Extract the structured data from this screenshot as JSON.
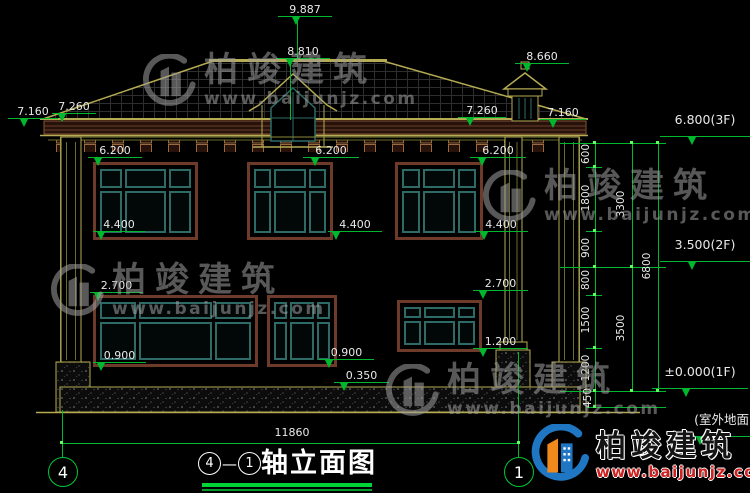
{
  "watermark": {
    "brand": "柏竣建筑",
    "url": "www.baijunjz.com"
  },
  "logo": {
    "brand": "柏竣建筑",
    "url": "www.baijunjz.com"
  },
  "title": {
    "axis_left": "4",
    "separator": "—",
    "axis_right": "1",
    "text": "轴立面图"
  },
  "axes": {
    "left": "4",
    "right": "1"
  },
  "dims": {
    "ridge": "9.887",
    "dormer": "8.810",
    "chimney": "8.660",
    "eave_outer_left": "7.160",
    "eave_inner_left": "7.260",
    "eave_inner_right": "7.260",
    "eave_outer_right": "7.160",
    "f2_top": [
      "6.200",
      "6.200",
      "6.200"
    ],
    "f2_sill": [
      "4.400",
      "4.400",
      "4.400"
    ],
    "f1_top": [
      "2.700",
      "2.700"
    ],
    "f1_sill": [
      "0.900",
      "0.900"
    ],
    "porch_step": "0.350",
    "f1_sill_right": "1.200",
    "total_width": "11860"
  },
  "chain": {
    "segments": [
      "600",
      "1800",
      "900",
      "800",
      "1500",
      "1200",
      "450"
    ],
    "subtotals": [
      "3300",
      "3500"
    ],
    "total": "6800"
  },
  "levels": {
    "roof": "6.800(3F)",
    "second": "3.500(2F)",
    "first": "±0.000(1F)",
    "ground": "(室外地面)"
  }
}
